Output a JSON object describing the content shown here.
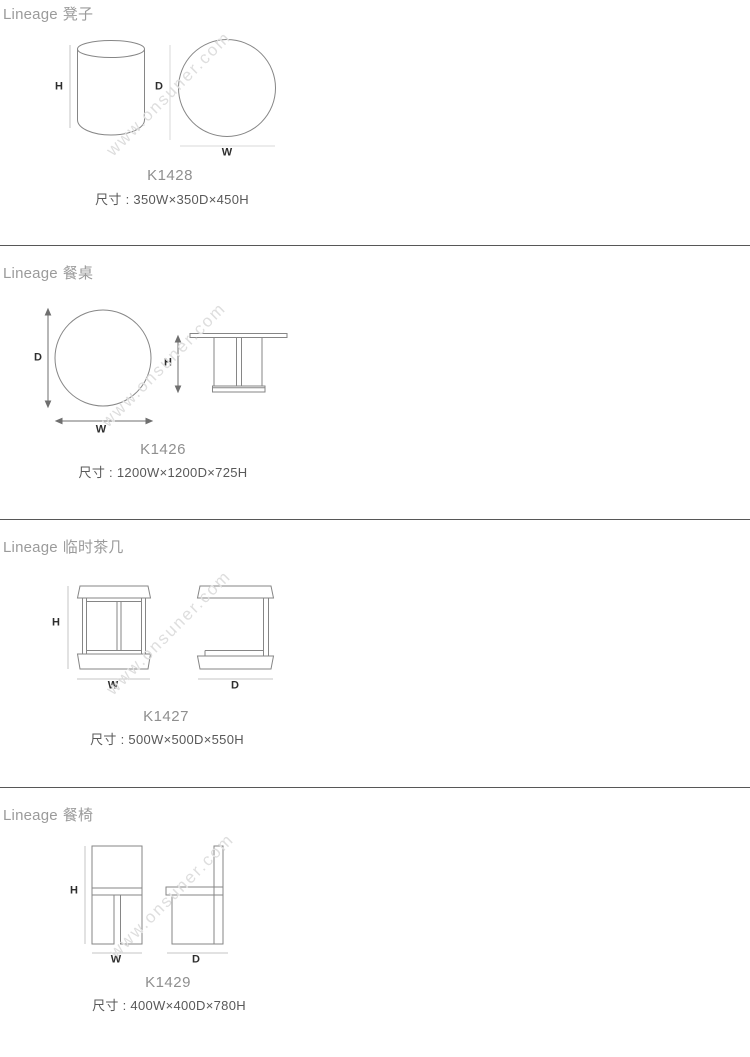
{
  "page": {
    "watermark": "www.onsuner.com"
  },
  "sections": [
    {
      "series": "Lineage",
      "name": "凳子",
      "model": "K1428",
      "size": "尺寸 : 350W×350D×450H",
      "labels": {
        "h": "H",
        "d": "D",
        "w": "W"
      }
    },
    {
      "series": "Lineage",
      "name": "餐桌",
      "model": "K1426",
      "size": "尺寸 : 1200W×1200D×725H",
      "labels": {
        "h": "H",
        "d": "D",
        "w": "W"
      }
    },
    {
      "series": "Lineage",
      "name": "临时茶几",
      "model": "K1427",
      "size": "尺寸 : 500W×500D×550H",
      "labels": {
        "h": "H",
        "d": "D",
        "w": "W"
      }
    },
    {
      "series": "Lineage",
      "name": "餐椅",
      "model": "K1429",
      "size": "尺寸 : 400W×400D×780H",
      "labels": {
        "h": "H",
        "d": "D",
        "w": "W"
      }
    }
  ]
}
